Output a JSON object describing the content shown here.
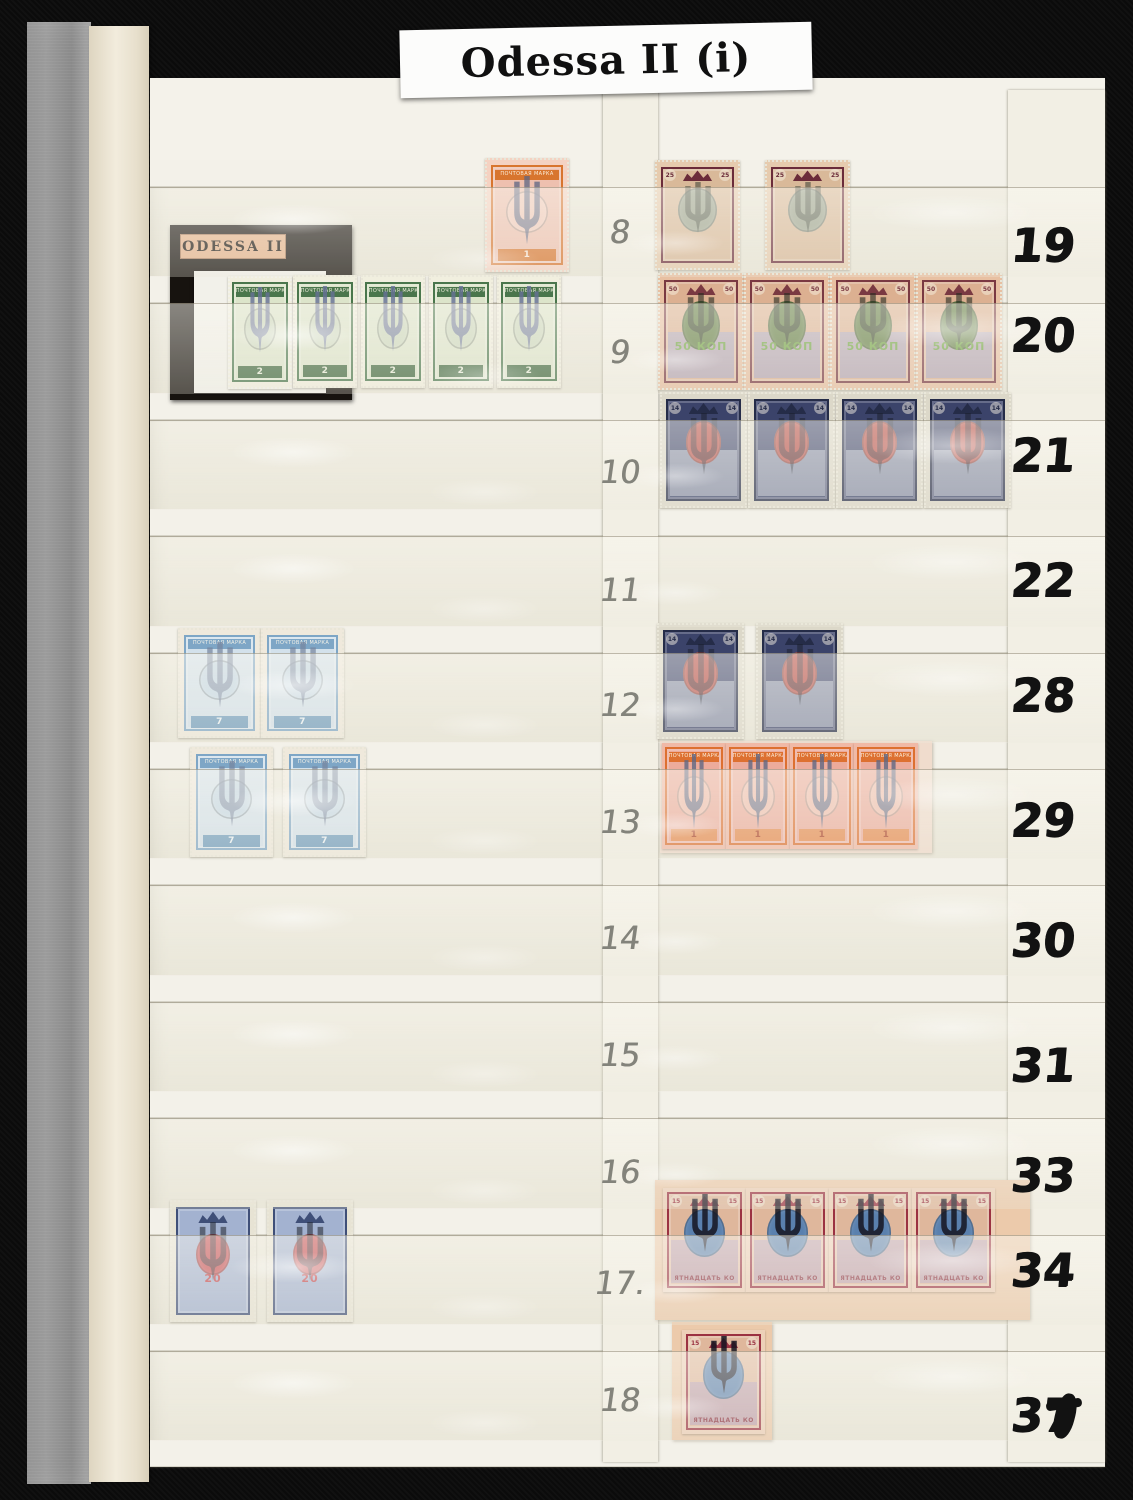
{
  "title_label": {
    "text": "Odessa II (i)"
  },
  "card_label": {
    "text": "ODESSA II"
  },
  "left_row_numbers": [
    "8",
    "9",
    "10",
    "11",
    "12",
    "13",
    "14",
    "15",
    "16",
    "17.",
    "18"
  ],
  "right_row_numbers": [
    "19",
    "20",
    "21",
    "22",
    "28",
    "29",
    "30",
    "31",
    "33",
    "34",
    "37"
  ],
  "right_37_has_ink_blot": true,
  "colors": {
    "album_black": "#0b0b0b",
    "page_cream": "#e9e6d8",
    "pocket_strip_white": "#f3f1e9",
    "glassine_grey": "#8e8e8e",
    "glassine_cream": "#ede5d2",
    "title_label_bg": "#fcfcfb",
    "card_black": "#17130f",
    "card_label_bg": "#e5b38c",
    "marker_ink": "#121212",
    "pencil": "#83837b",
    "backing_tan": "#eccaab"
  },
  "overprint_symbol": "ukrainian-trident",
  "stamp_types": {
    "green2": {
      "perf": true,
      "w": 64,
      "h": 113,
      "paper": "#f1efdf",
      "frame": "#4a764c",
      "body": "#dce4ca",
      "oval": "#cbd7bc",
      "oval_rect": [
        21,
        26,
        58,
        42
      ],
      "band_text": "ПОЧТОВАЯ МАРКА",
      "tab_text": "2",
      "tab_bg": "#40683f",
      "tab_color": "#e9eedb",
      "trident_color": "#667097",
      "trident_opacity": 0.8,
      "trident_top": 0.1,
      "trident_h": 0.6,
      "value_label": "2"
    },
    "orange1": {
      "perf": true,
      "w": 84,
      "h": 114,
      "paper": "#f4d2c2",
      "frame": "#d8752e",
      "body": "#eec0af",
      "oval": "#f2cabb",
      "oval_rect": [
        21,
        26,
        58,
        42
      ],
      "band_text": "ПОЧТОВАЯ МАРКА",
      "tab_text": "1",
      "tab_bg": "#d8752e",
      "tab_color": "#fbe9dc",
      "trident_color": "#5d6684",
      "trident_opacity": 0.75,
      "trident_top": 0.16,
      "trident_h": 0.62,
      "value_label": "1"
    },
    "blue7": {
      "perf": true,
      "w": 83,
      "h": 110,
      "paper": "#efe9dc",
      "frame": "#7ea6c6",
      "body": "#d3e1eb",
      "oval": "#c3d7e5",
      "oval_rect": [
        21,
        26,
        58,
        42
      ],
      "band_text": "ПОЧТОВАЯ МАРКА",
      "tab_text": "7",
      "tab_bg": "#6f9cbd",
      "tab_color": "#eef5f8",
      "trident_color": "#76849e",
      "trident_opacity": 0.7,
      "trident_top": 0.13,
      "trident_h": 0.62,
      "value_label": "7"
    },
    "k20": {
      "perf": true,
      "w": 86,
      "h": 122,
      "paper": "#e7e3d4",
      "frame": "#3f4f78",
      "body": "#a3b2d0",
      "oval": "#c4484e",
      "oval_rect": [
        27,
        25,
        46,
        38
      ],
      "crest": true,
      "mid_text": "20",
      "mid_color": "#c23f46",
      "mid_top": 0.6,
      "trident_color": "#20242e",
      "trident_opacity": 0.55,
      "trident_top": 0.18,
      "trident_h": 0.5,
      "value_label": "20"
    },
    "k25": {
      "perf": true,
      "w": 85,
      "h": 110,
      "paper": "#e6cbae",
      "frame": "#6b2c3a",
      "body": "#d9b999",
      "oval": "#99a18c",
      "oval_rect": [
        24,
        22,
        52,
        46
      ],
      "crest": true,
      "corner_text": "25",
      "trident_color": "#3a4034",
      "trident_opacity": 0.55,
      "trident_top": 0.2,
      "trident_h": 0.48,
      "value_label": "25"
    },
    "k50": {
      "perf": true,
      "w": 86,
      "h": 117,
      "paper": "#e8c0a2",
      "frame": "#7a3942",
      "body": "#dcb091",
      "oval": "#5c783d",
      "oval_rect": [
        24,
        20,
        52,
        48
      ],
      "lower": "#b2a5b5",
      "crest": true,
      "corner_text": "50",
      "mid_text": "50 КОП",
      "mid_color": "#6da23f",
      "mid_top": 0.58,
      "trident_color": "#262b20",
      "trident_opacity": 0.6,
      "trident_top": 0.17,
      "trident_h": 0.46,
      "value_label": "50 КОП"
    },
    "k14": {
      "perf": true,
      "w": 87,
      "h": 116,
      "paper": "#dcd8c9",
      "frame": "#252c48",
      "body": "#3b436a",
      "oval": "#b5453e",
      "oval_rect": [
        26,
        22,
        48,
        42
      ],
      "lower": "#8d95ac",
      "crest": true,
      "corner_text": "14",
      "trident_color": "#1b1f2c",
      "trident_opacity": 0.5,
      "trident_top": 0.18,
      "trident_h": 0.55,
      "value_label": "14"
    },
    "orange1imp": {
      "perf": false,
      "w": 64,
      "h": 106,
      "paper": "#f0b9a6",
      "frame": "#dd7030",
      "body": "#ecab9b",
      "oval": "#f0bcab",
      "oval_rect": [
        20,
        30,
        60,
        42
      ],
      "band_text": "ПОЧТОВАЯ МАРКА",
      "tab_text": "1",
      "tab_bg": "#e68b4f",
      "tab_color": "#a83c1f",
      "trident_color": "#5f6884",
      "trident_opacity": 0.8,
      "trident_top": 0.1,
      "trident_h": 0.74,
      "value_label": "1"
    },
    "k15imp": {
      "perf": false,
      "w": 83,
      "h": 104,
      "paper": "#edd0b8",
      "frame": "#9b3242",
      "body": "#dfb79c",
      "oval": "#5a80ae",
      "oval_rect": [
        22,
        18,
        56,
        50
      ],
      "lower": "#bfa1ae",
      "crest": true,
      "corner_text": "15",
      "tab_text": "ПЯТНАДЦАТЬ КОП",
      "tab_bg": "transparent",
      "tab_color": "#8a2f3e",
      "trident_color": "#151520",
      "trident_opacity": 0.85,
      "trident_top": 0.06,
      "trident_h": 0.58,
      "value_label": "15"
    }
  },
  "stamp_groups": [
    {
      "id": "row8",
      "row_label": "8",
      "type": "orange1",
      "count": 1,
      "arrangement": "single"
    },
    {
      "id": "row9",
      "row_label": "9",
      "type": "green2",
      "count": 4,
      "arrangement": "separate"
    },
    {
      "id": "row12",
      "row_label": "12",
      "type": "blue7",
      "count": 2,
      "arrangement": "pair"
    },
    {
      "id": "row13",
      "row_label": "13",
      "type": "blue7",
      "count": 2,
      "arrangement": "separate"
    },
    {
      "id": "row17",
      "row_label": "17",
      "type": "k20",
      "count": 2,
      "arrangement": "separate"
    },
    {
      "id": "row19",
      "row_label": "19",
      "type": "k25",
      "count": 2,
      "arrangement": "separate"
    },
    {
      "id": "row20",
      "row_label": "20",
      "type": "k50",
      "count": 4,
      "arrangement": "strip"
    },
    {
      "id": "row21",
      "row_label": "21",
      "type": "k14",
      "count": 4,
      "arrangement": "strip"
    },
    {
      "id": "row28",
      "row_label": "28",
      "type": "k14",
      "count": 2,
      "arrangement": "separate"
    },
    {
      "id": "row29",
      "row_label": "29",
      "type": "orange1imp",
      "count": 4,
      "arrangement": "strip"
    },
    {
      "id": "row33",
      "row_label": "33/34",
      "type": "k15imp",
      "count": 4,
      "arrangement": "strip"
    },
    {
      "id": "row37",
      "row_label": "37",
      "type": "k15imp",
      "count": 1,
      "arrangement": "single"
    }
  ],
  "card_stamp": {
    "type": "green2",
    "row_label": "9"
  }
}
